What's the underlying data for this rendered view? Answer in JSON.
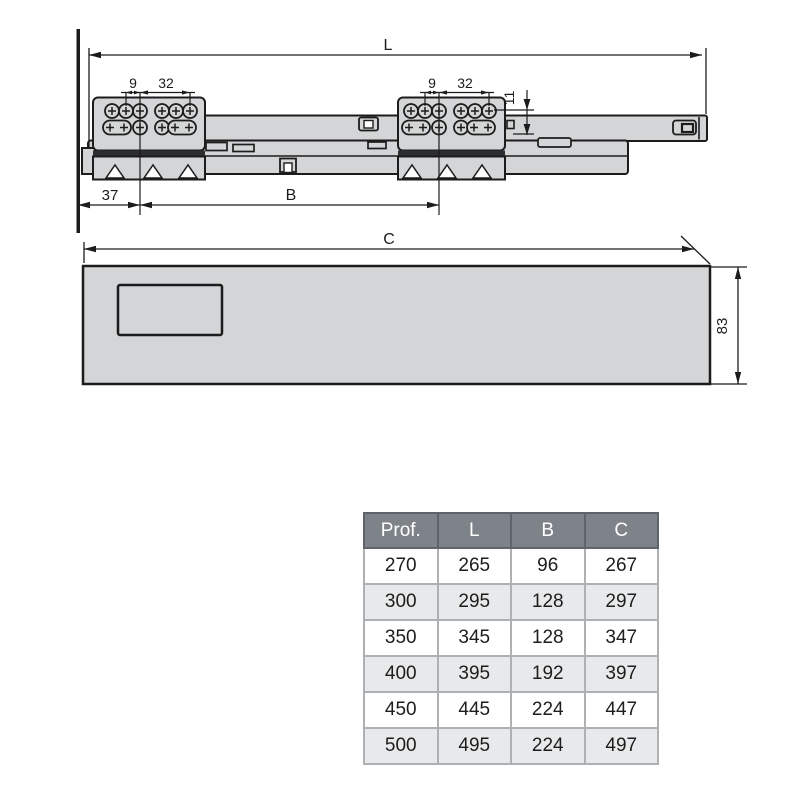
{
  "slide_drawing": {
    "dim_overall_length": "L",
    "dim_front_offset": "37",
    "dim_bracket_span": "B",
    "front_bracket": {
      "dim_pitch_small": "9",
      "dim_pitch_large": "32"
    },
    "rear_bracket": {
      "dim_pitch_small": "9",
      "dim_pitch_large": "32",
      "dim_row_offset": "11"
    }
  },
  "panel_drawing": {
    "dim_length": "C",
    "dim_height": "83"
  },
  "size_table": {
    "headers": [
      "Prof.",
      "L",
      "B",
      "C"
    ],
    "rows": [
      [
        "270",
        "265",
        "96",
        "267"
      ],
      [
        "300",
        "295",
        "128",
        "297"
      ],
      [
        "350",
        "345",
        "128",
        "347"
      ],
      [
        "400",
        "395",
        "192",
        "397"
      ],
      [
        "450",
        "445",
        "224",
        "447"
      ],
      [
        "500",
        "495",
        "224",
        "497"
      ]
    ]
  },
  "colors": {
    "drawing_fill": "#d3d5d7",
    "drawing_outline": "#1c1c1c",
    "dark_accent": "#2c2e30",
    "table_header_bg": "#7e838a",
    "table_header_text": "#ffffff",
    "table_alt_row_bg": "#e8e9ea"
  }
}
